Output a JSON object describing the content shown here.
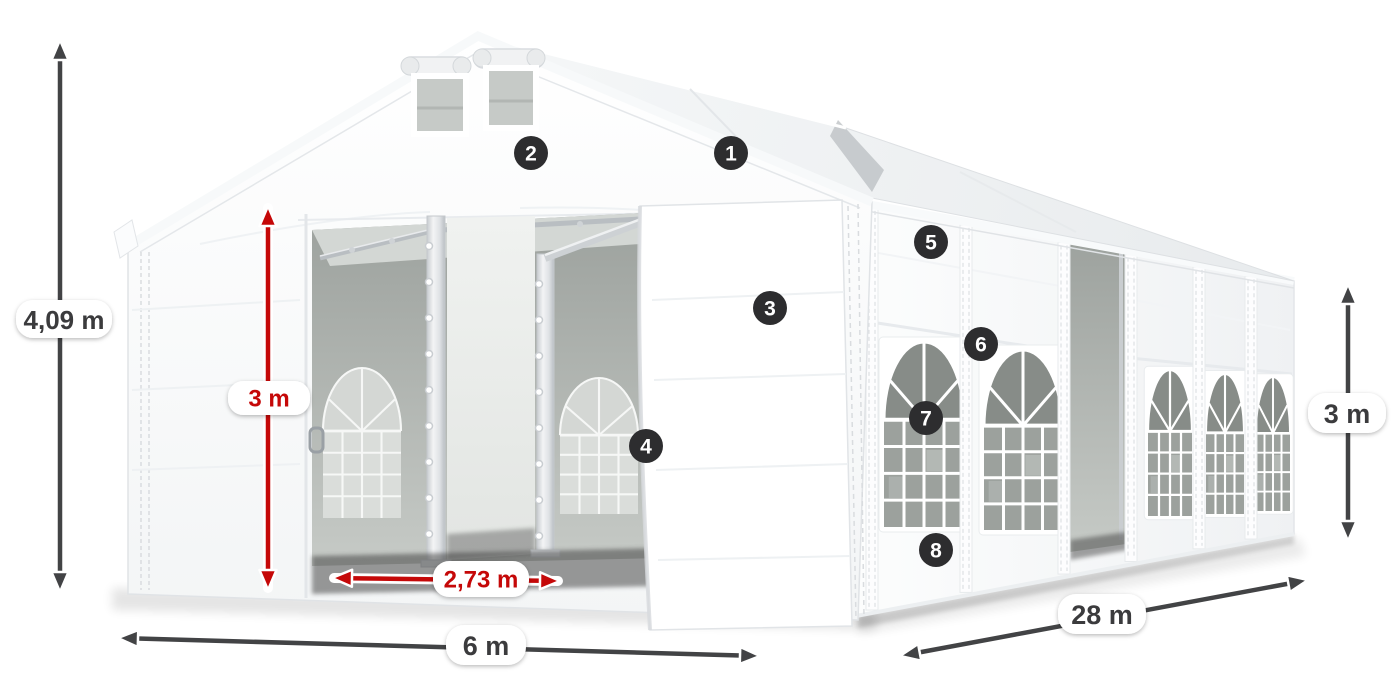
{
  "colors": {
    "canvas_bg": "#ffffff",
    "dimension_dark": "#424345",
    "dimension_red": "#c50808",
    "pill_bg": "#ffffff",
    "pill_text_dark": "#3b3b3d",
    "pill_text_red": "#c50808",
    "badge_bg": "#2d2d2f",
    "badge_text": "#ffffff"
  },
  "dimensions": [
    {
      "id": "total-height",
      "label": "4,09 m",
      "style": "dark",
      "x1": 60,
      "y1": 40,
      "x2": 60,
      "y2": 592,
      "label_cx": 64,
      "label_cy": 319,
      "pill_w": 96,
      "pill_h": 38,
      "font_size": 26
    },
    {
      "id": "entrance-height",
      "label": "3 m",
      "style": "red",
      "x1": 268,
      "y1": 206,
      "x2": 268,
      "y2": 590,
      "label_cx": 269,
      "label_cy": 398,
      "pill_w": 82,
      "pill_h": 34,
      "font_size": 24
    },
    {
      "id": "entrance-width",
      "label": "2,73 m",
      "style": "red",
      "x1": 332,
      "y1": 578,
      "x2": 560,
      "y2": 581,
      "label_cx": 481,
      "label_cy": 579,
      "pill_w": 96,
      "pill_h": 36,
      "font_size": 24
    },
    {
      "id": "front-width",
      "label": "6 m",
      "style": "dark",
      "x1": 118,
      "y1": 638,
      "x2": 760,
      "y2": 656,
      "label_cx": 486,
      "label_cy": 645,
      "pill_w": 80,
      "pill_h": 40,
      "font_size": 27
    },
    {
      "id": "side-length",
      "label": "28 m",
      "style": "dark",
      "x1": 900,
      "y1": 656,
      "x2": 1308,
      "y2": 580,
      "label_cx": 1102,
      "label_cy": 614,
      "pill_w": 88,
      "pill_h": 40,
      "font_size": 27
    },
    {
      "id": "side-height",
      "label": "3 m",
      "style": "dark",
      "x1": 1348,
      "y1": 284,
      "x2": 1348,
      "y2": 541,
      "label_cx": 1347,
      "label_cy": 413,
      "pill_w": 78,
      "pill_h": 40,
      "font_size": 27
    }
  ],
  "callouts": [
    {
      "num": "1",
      "cx": 731,
      "cy": 153
    },
    {
      "num": "2",
      "cx": 531,
      "cy": 153
    },
    {
      "num": "3",
      "cx": 770,
      "cy": 308
    },
    {
      "num": "4",
      "cx": 646,
      "cy": 446
    },
    {
      "num": "5",
      "cx": 931,
      "cy": 242
    },
    {
      "num": "6",
      "cx": 981,
      "cy": 344
    },
    {
      "num": "7",
      "cx": 926,
      "cy": 418
    },
    {
      "num": "8",
      "cx": 936,
      "cy": 550
    }
  ],
  "badge_radius": 17
}
